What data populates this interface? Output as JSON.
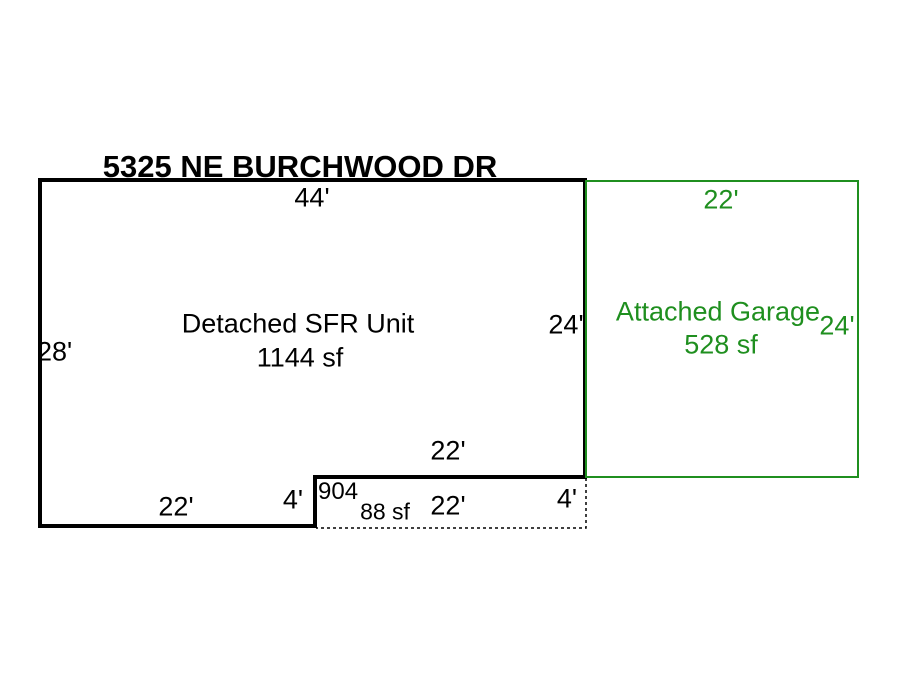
{
  "title": "5325 NE BURCHWOOD DR",
  "colors": {
    "outline_black": "#000000",
    "garage_green": "#1f8f1f",
    "background": "#ffffff"
  },
  "main_unit": {
    "label": "Detached SFR Unit",
    "area": "1144 sf",
    "dim_top": "44'",
    "dim_left": "28'",
    "dim_right": "24'",
    "dim_bottom_left": "22'",
    "dim_step_height": "4'",
    "dim_step_top": "22'"
  },
  "garage": {
    "label": "Attached Garage",
    "area": "528 sf",
    "dim_top": "22'",
    "dim_right": "24'"
  },
  "porch": {
    "code": "904",
    "area": "88 sf",
    "dim_width": "22'",
    "dim_height": "4'"
  }
}
